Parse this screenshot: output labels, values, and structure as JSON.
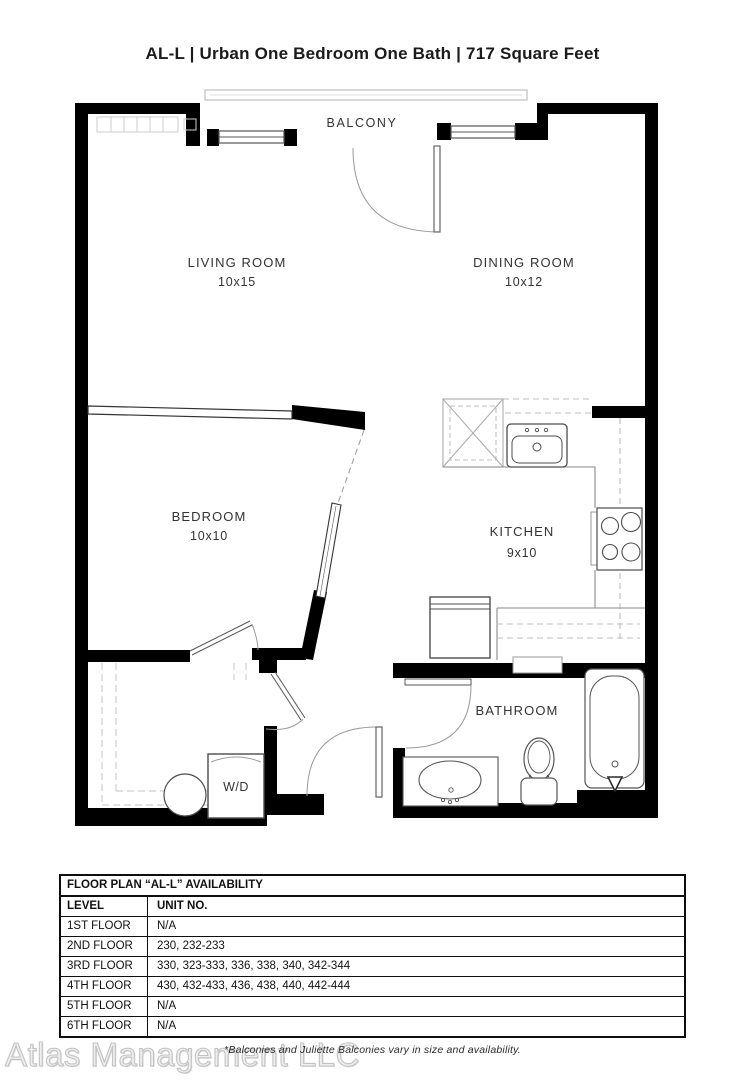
{
  "title": "AL-L | Urban One Bedroom One Bath | 717 Square Feet",
  "plan": {
    "balcony": "BALCONY",
    "living": {
      "name": "LIVING ROOM",
      "dims": "10x15"
    },
    "dining": {
      "name": "DINING ROOM",
      "dims": "10x12"
    },
    "bedroom": {
      "name": "BEDROOM",
      "dims": "10x10"
    },
    "kitchen": {
      "name": "KITCHEN",
      "dims": "9x10"
    },
    "bathroom": {
      "name": "BATHROOM"
    },
    "washer_dryer": "W/D"
  },
  "availability": {
    "title": "FLOOR PLAN “AL-L” AVAILABILITY",
    "columns": [
      "LEVEL",
      "UNIT NO."
    ],
    "rows": [
      {
        "level": "1ST FLOOR",
        "units": "N/A"
      },
      {
        "level": "2ND FLOOR",
        "units": "230, 232-233"
      },
      {
        "level": "3RD FLOOR",
        "units": "330, 323-333, 336, 338, 340, 342-344"
      },
      {
        "level": "4TH FLOOR",
        "units": "430, 432-433, 436, 438, 440, 442-444"
      },
      {
        "level": "5TH FLOOR",
        "units": "N/A"
      },
      {
        "level": "6TH FLOOR",
        "units": "N/A"
      }
    ]
  },
  "footnote": "*Balconies and Juliette Balconies vary in size and availability.",
  "watermark": "Atlas Management LLC",
  "colors": {
    "wall": "#000000",
    "fixture_line": "#4c4c4c",
    "light_line": "#c9c9c9",
    "text": "#333333",
    "watermark": "#c3c3c3"
  }
}
